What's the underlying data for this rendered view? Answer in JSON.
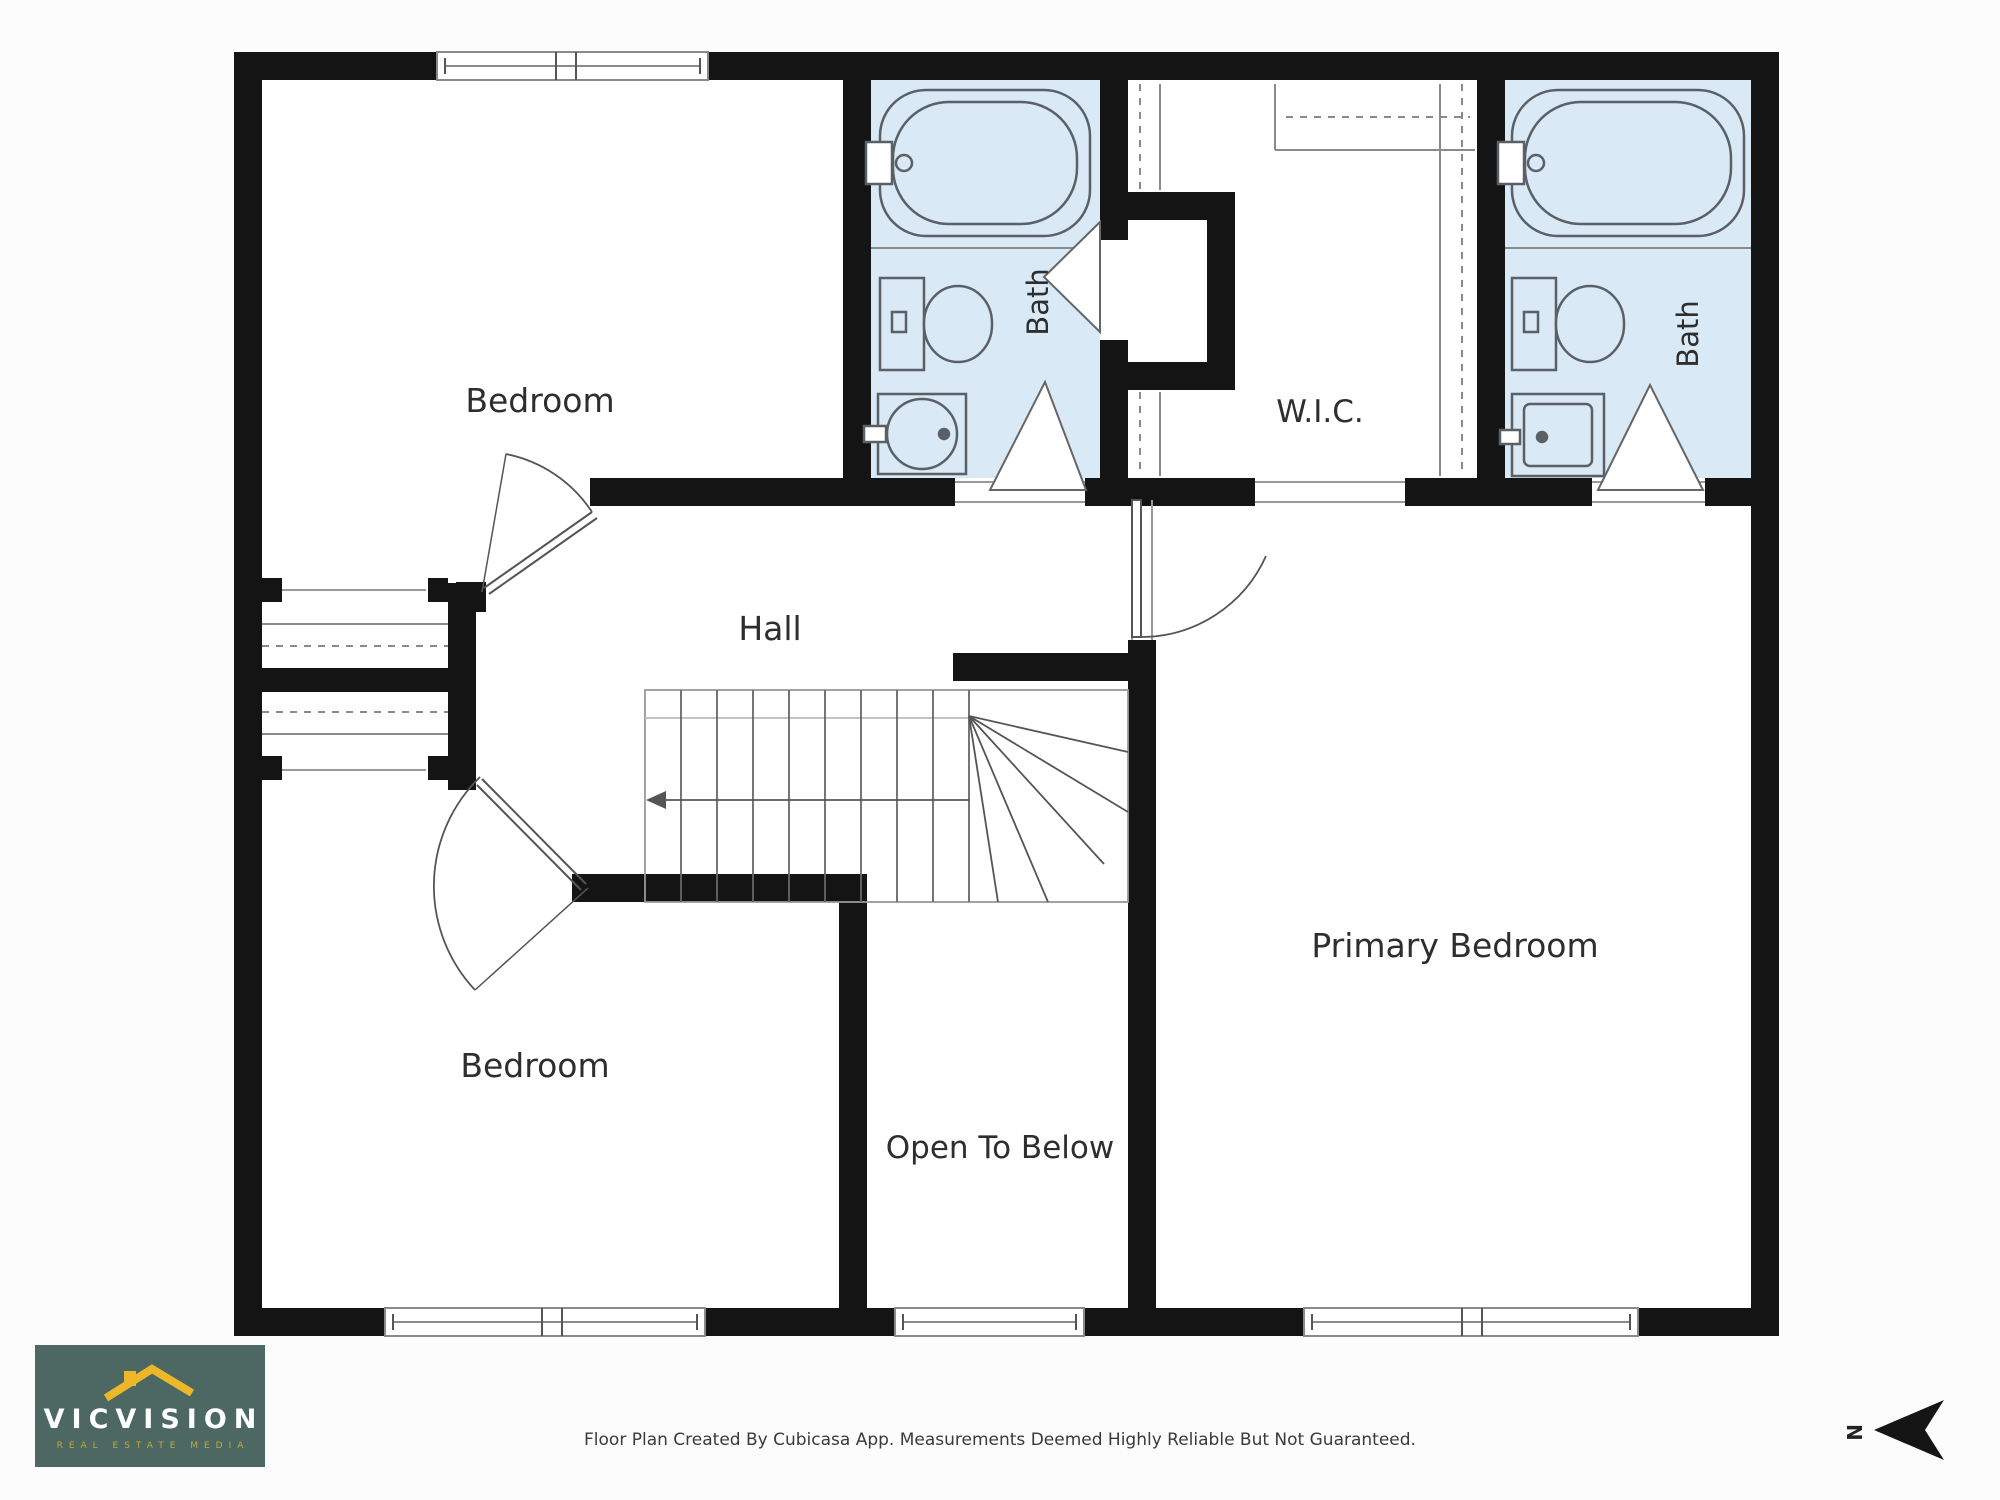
{
  "rooms": {
    "bedroom_top": {
      "label": "Bedroom"
    },
    "bath_left": {
      "label": "Bath",
      "floor_color": "#d9e9f6",
      "fixtures": [
        "bathtub",
        "toilet",
        "pedestal-sink"
      ]
    },
    "wic": {
      "label": "W.I.C.",
      "fixtures": [
        "closet-rod-left",
        "closet-rod-right",
        "top-shelf",
        "linen-niche"
      ]
    },
    "bath_right": {
      "label": "Bath",
      "floor_color": "#d9e9f6",
      "fixtures": [
        "bathtub",
        "toilet",
        "vanity-sink"
      ]
    },
    "hall": {
      "label": "Hall"
    },
    "primary": {
      "label": "Primary Bedroom"
    },
    "open_below": {
      "label": "Open To Below"
    },
    "bedroom_bottom": {
      "label": "Bedroom"
    }
  },
  "branding": {
    "name": "VICVISION",
    "tagline": "REAL ESTATE MEDIA",
    "background": "#4d6862",
    "roof_color": "#ecb82a",
    "text_color": "#ffffff"
  },
  "footer": {
    "disclaimer": "Floor Plan Created By Cubicasa App. Measurements Deemed Highly Reliable But Not Guaranteed."
  },
  "compass": {
    "label": "N"
  },
  "colors": {
    "wall": "#141414",
    "bath_floor": "#d9e9f6",
    "fixture_line": "#5a6066",
    "thin_line": "#999999",
    "floor": "#ffffff"
  }
}
